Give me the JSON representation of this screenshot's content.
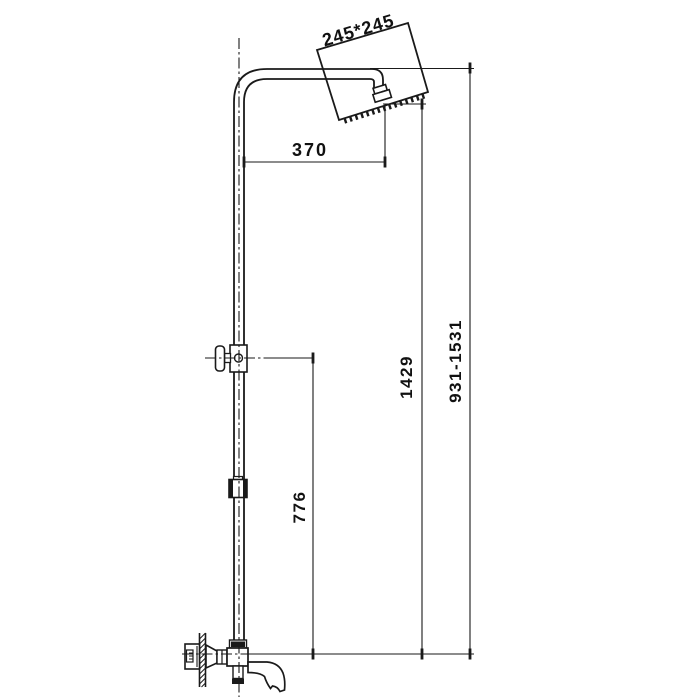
{
  "diagram": {
    "labels": {
      "head_size": "245*245",
      "arm_projection": "370",
      "upper_height": "1429",
      "overall_height_range": "931-1531",
      "lower_height": "776"
    },
    "colors": {
      "line": "#1a1a1a",
      "background": "#ffffff"
    }
  }
}
